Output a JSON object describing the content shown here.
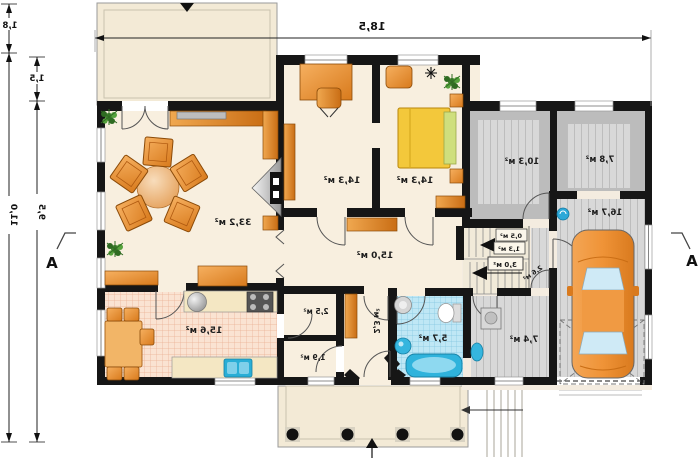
{
  "plan": {
    "dimensions": {
      "top_width": "18,5",
      "left_offset_top": "1,8",
      "left_offset_inner": "1,5",
      "left_total": "11,0",
      "left_inner": "9,5"
    },
    "section": {
      "left": "A",
      "right": "A"
    },
    "rooms": {
      "living": "33,2 м²",
      "office": "14,3 м²",
      "bedroom": "14,3 м²",
      "hall": "15,0 м²",
      "kitchen": "15,6 м²",
      "pantry": "2,5 м²",
      "larder": "1,9 м²",
      "vestibule": "2,3 м²",
      "bathroom": "5,7 м²",
      "utility": "7,4 м²",
      "boiler_room": "10,3 м²",
      "storage": "7,8 м²",
      "garage": "16,7 м²",
      "under_stairs_small": "0,5 м²",
      "under_stairs_large": "1,3 м²",
      "stairs": "3,0 м²",
      "lobby": "2,6 м²"
    }
  }
}
